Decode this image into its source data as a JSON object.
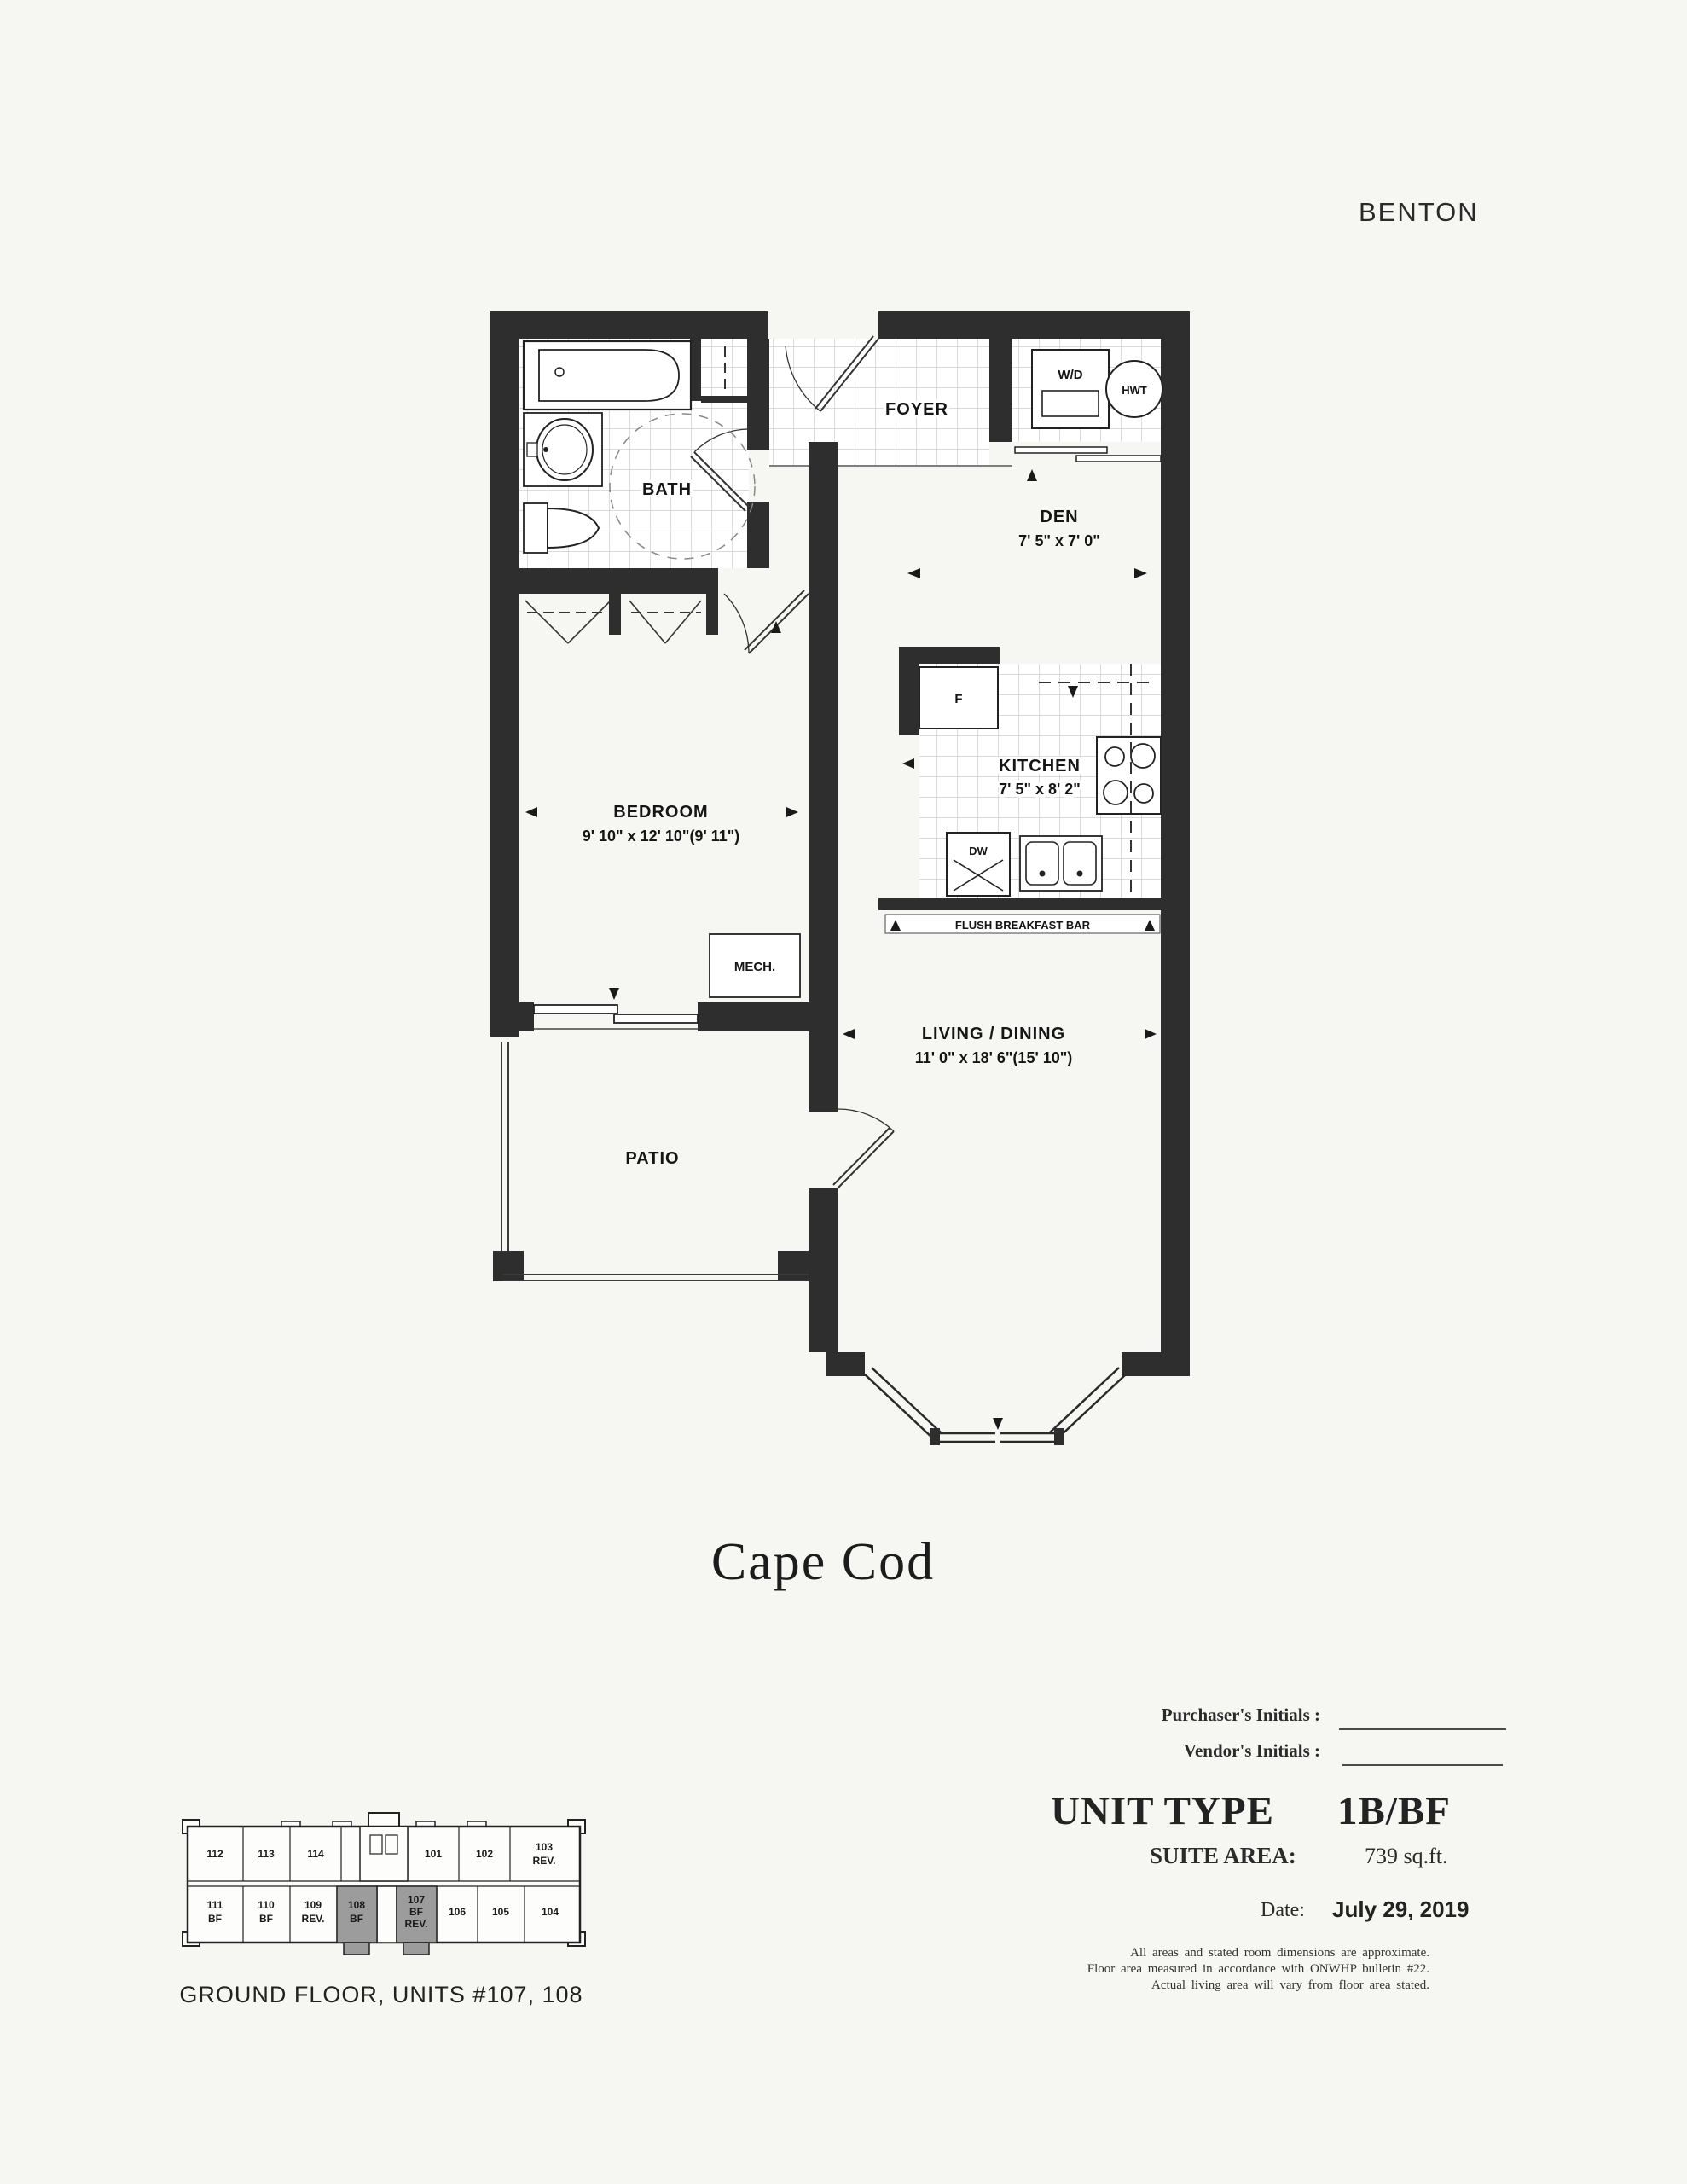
{
  "header": {
    "project_name": "BENTON"
  },
  "plan_title": "Cape Cod",
  "floor_plan": {
    "rooms": {
      "bath": {
        "label": "BATH"
      },
      "foyer": {
        "label": "FOYER"
      },
      "den": {
        "label": "DEN",
        "dims": "7' 5\" x 7' 0\""
      },
      "kitchen": {
        "label": "KITCHEN",
        "dims": "7' 5\" x 8' 2\""
      },
      "bedroom": {
        "label": "BEDROOM",
        "dims": "9' 10\" x 12' 10\"(9' 11\")"
      },
      "mech": {
        "label": "MECH."
      },
      "living_dining": {
        "label": "LIVING / DINING",
        "dims": "11' 0\" x 18' 6\"(15' 10\")"
      },
      "patio": {
        "label": "PATIO"
      }
    },
    "fixtures": {
      "washer_dryer": "W/D",
      "hot_water_tank": "HWT",
      "fridge": "F",
      "dishwasher": "DW",
      "breakfast_bar": "FLUSH BREAKFAST BAR"
    }
  },
  "signature_block": {
    "purchaser_label": "Purchaser's Initials :",
    "vendor_label": "Vendor's Initials :"
  },
  "unit_info": {
    "unit_type_label": "UNIT TYPE",
    "unit_type_value": "1B/BF",
    "suite_area_label": "SUITE AREA:",
    "suite_area_value": "739 sq.ft.",
    "date_label": "Date:",
    "date_value": "July 29, 2019"
  },
  "disclaimer": {
    "line1": "All areas and stated room dimensions are approximate.",
    "line2": "Floor area measured in accordance with ONWHP bulletin #22.",
    "line3": "Actual living area will vary from floor area stated."
  },
  "key_plan": {
    "caption": "GROUND FLOOR, UNITS #107, 108",
    "units": {
      "u112": "112",
      "u113": "113",
      "u114": "114",
      "u101": "101",
      "u102": "102",
      "u103": "103",
      "u103b": "REV.",
      "u111": "111",
      "u111b": "BF",
      "u110": "110",
      "u110b": "BF",
      "u109": "109",
      "u109b": "REV.",
      "u108": "108",
      "u108b": "BF",
      "u107": "107",
      "u107b": "BF",
      "u107c": "REV.",
      "u106": "106",
      "u105": "105",
      "u104": "104"
    }
  }
}
